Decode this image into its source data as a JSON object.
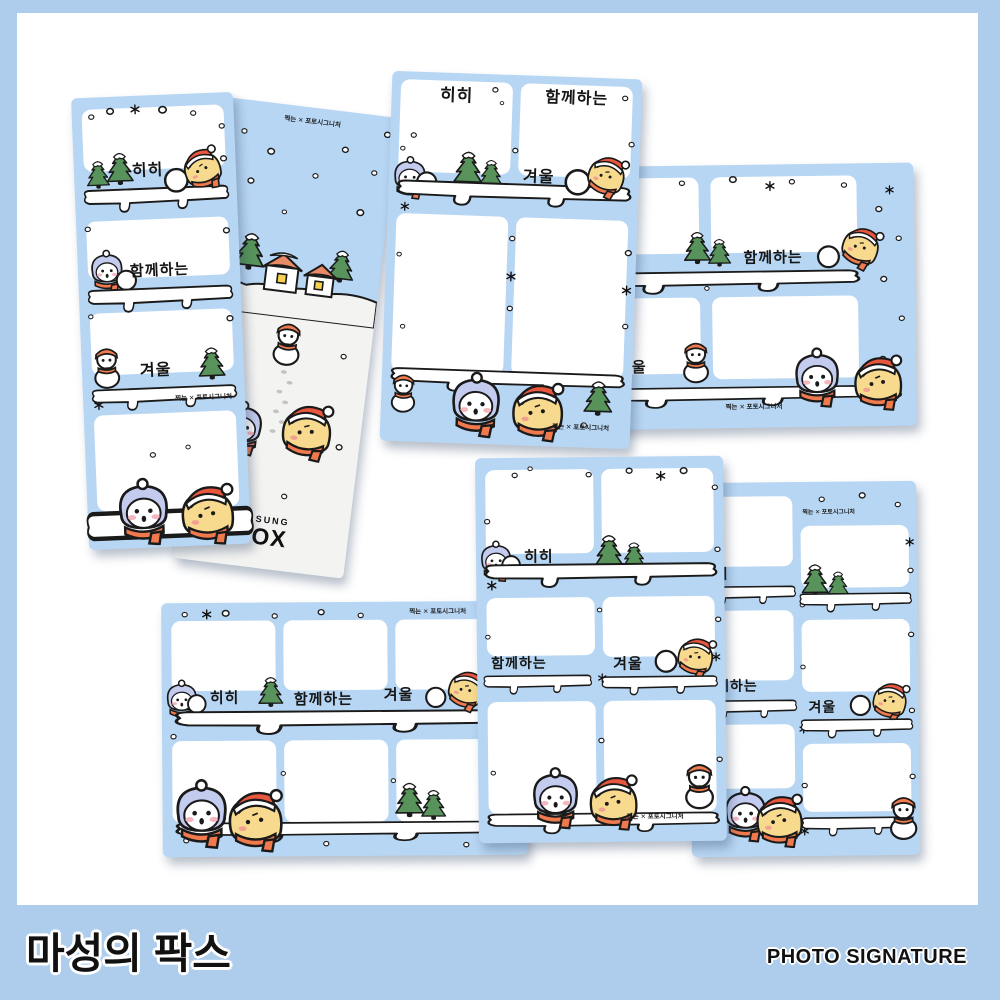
{
  "product": {
    "frame_labels": {
      "hihi": "히히",
      "together": "함께하는",
      "winter": "겨울"
    },
    "brand_credit": "찍는 ✕ 포토시그니처",
    "logo": {
      "top": "MASUNG",
      "bottom": "FOX"
    }
  },
  "footer": {
    "left_title": "마성의 팍스",
    "right_title": "PHOTO SIGNATURE"
  },
  "colors": {
    "background_blue": "#aecdec",
    "card_blue": "#b7d6f3",
    "paper_white": "#ffffff",
    "snow_ground": "#f3f3f1",
    "outline_black": "#1a1a1a",
    "scarf_orange": "#f0794e",
    "hood_lavender": "#c3cbee",
    "chick_yellow": "#f8da8e",
    "hat_red": "#e8563e",
    "tree_green": "#57935a",
    "roof_orange": "#e98a67",
    "window_yellow": "#f7d34d"
  }
}
